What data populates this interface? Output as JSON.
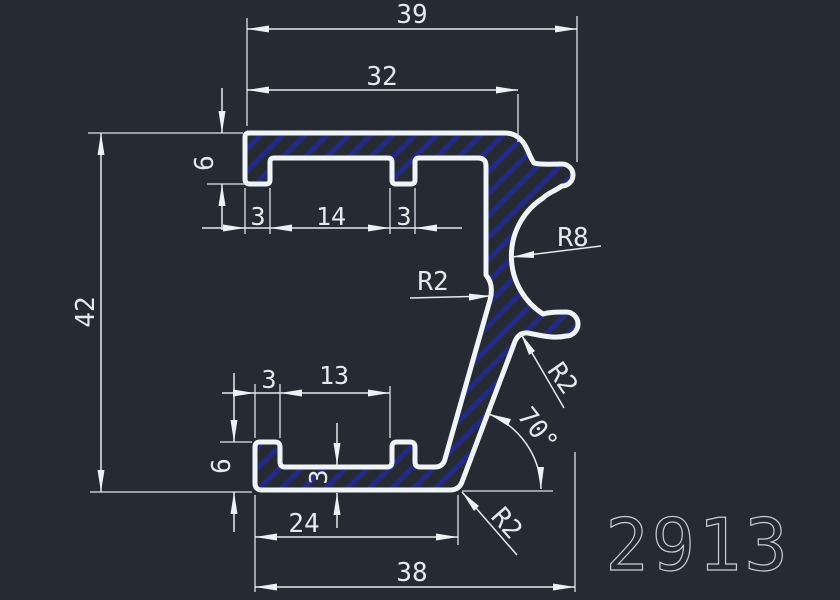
{
  "drawing": {
    "title": "Aluminium profile cross-section 2913",
    "part_number": "2913",
    "dims": {
      "top_overall": "39",
      "top_inner": "32",
      "overall_height": "42",
      "top_leg_depth": "6",
      "top_leg_width": "3",
      "top_recess_width": "14",
      "top_tab_width": "3",
      "mid_radius": "R2",
      "top_hook_radius": "R8",
      "lower_hook_radius": "R2",
      "angle": "70°",
      "corner_radius": "R2",
      "bottom_leg_width": "3",
      "bottom_recess_width": "13",
      "bottom_leg_depth": "6",
      "bottom_floor_thickness": "3",
      "bottom_inner_width": "24",
      "bottom_overall": "38"
    },
    "colors": {
      "background": "#262b33",
      "profile_outline": "#f1f4f6",
      "hatch": "#222a85",
      "dimension": "#e6e9ec",
      "part_number": "#c9ced3"
    }
  }
}
